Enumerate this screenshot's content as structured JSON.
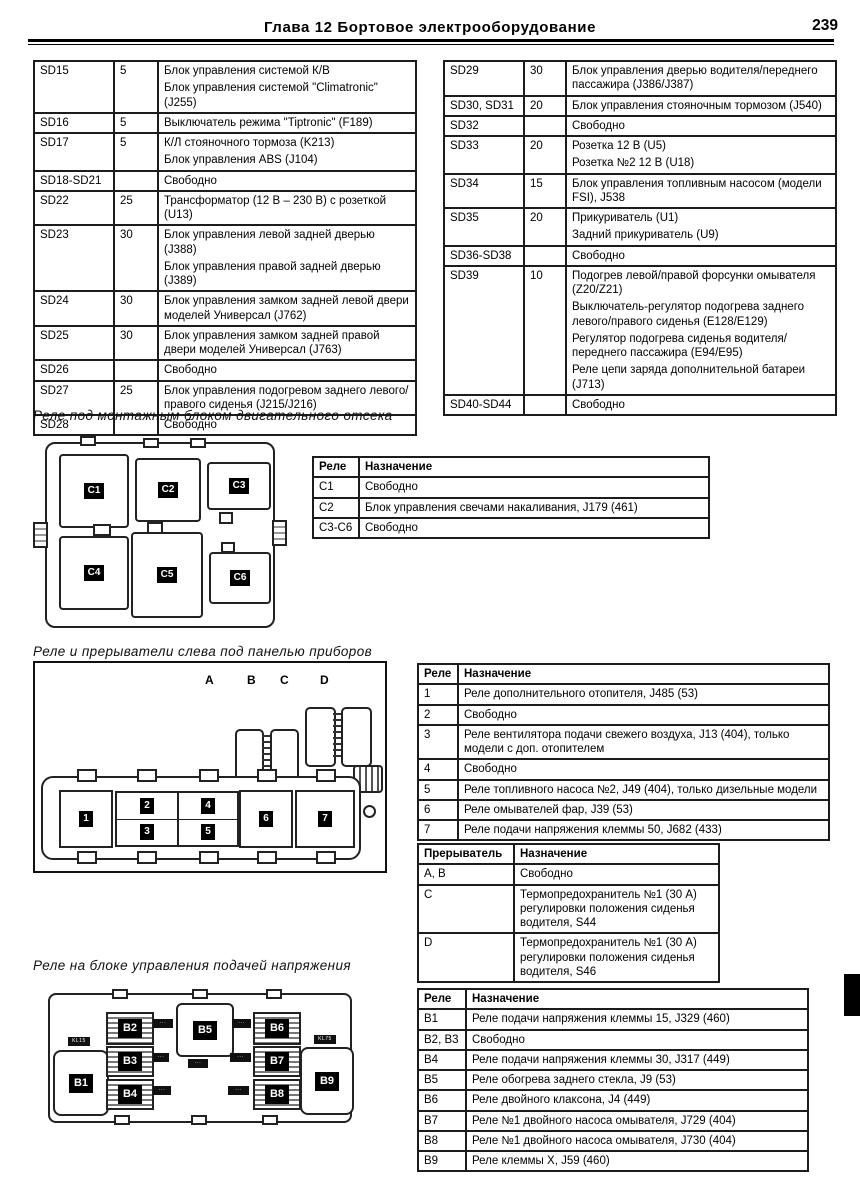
{
  "header": {
    "title": "Глава 12  Бортовое электрооборудование",
    "page_number": "239"
  },
  "fuse_left": {
    "rows": [
      {
        "id": "SD15",
        "amp": "5",
        "desc": [
          "Блок управления системой К/В",
          "Блок управления системой \"Climatronic\" (J255)"
        ]
      },
      {
        "id": "SD16",
        "amp": "5",
        "desc": [
          "Выключатель режима \"Tiptronic\" (F189)"
        ]
      },
      {
        "id": "SD17",
        "amp": "5",
        "desc": [
          "К/Л стояночного тормоза (K213)",
          "Блок управления ABS (J104)"
        ]
      },
      {
        "id": "SD18-SD21",
        "amp": "",
        "desc": [
          "Свободно"
        ]
      },
      {
        "id": "SD22",
        "amp": "25",
        "desc": [
          "Трансформатор (12 В – 230 В) с розеткой (U13)"
        ]
      },
      {
        "id": "SD23",
        "amp": "30",
        "desc": [
          "Блок управления левой задней дверью (J388)",
          "Блок управления правой задней дверью (J389)"
        ]
      },
      {
        "id": "SD24",
        "amp": "30",
        "desc": [
          "Блок управления замком задней левой двери моделей Универсал (J762)"
        ]
      },
      {
        "id": "SD25",
        "amp": "30",
        "desc": [
          "Блок управления замком задней правой двери моделей Универсал (J763)"
        ]
      },
      {
        "id": "SD26",
        "amp": "",
        "desc": [
          "Свободно"
        ]
      },
      {
        "id": "SD27",
        "amp": "25",
        "desc": [
          "Блок управления подогревом заднего левого/правого сиденья (J215/J216)"
        ]
      },
      {
        "id": "SD28",
        "amp": "",
        "desc": [
          "Свободно"
        ]
      }
    ]
  },
  "fuse_right": {
    "rows": [
      {
        "id": "SD29",
        "amp": "30",
        "desc": [
          "Блок управления дверью водителя/переднего пассажира (J386/J387)"
        ]
      },
      {
        "id": "SD30, SD31",
        "amp": "20",
        "desc": [
          "Блок управления стояночным тормозом (J540)"
        ]
      },
      {
        "id": "SD32",
        "amp": "",
        "desc": [
          "Свободно"
        ]
      },
      {
        "id": "SD33",
        "amp": "20",
        "desc": [
          "Розетка 12 В (U5)",
          "Розетка №2 12 В (U18)"
        ]
      },
      {
        "id": "SD34",
        "amp": "15",
        "desc": [
          "Блок управления топливным насосом (модели FSI), J538"
        ]
      },
      {
        "id": "SD35",
        "amp": "20",
        "desc": [
          "Прикуриватель (U1)",
          "Задний прикуриватель (U9)"
        ]
      },
      {
        "id": "SD36-SD38",
        "amp": "",
        "desc": [
          "Свободно"
        ]
      },
      {
        "id": "SD39",
        "amp": "10",
        "desc": [
          "Подогрев левой/правой форсунки омывателя (Z20/Z21)",
          "Выключатель-регулятор подогрева заднего левого/правого сиденья (E128/E129)",
          "Регулятор подогрева сиденья водителя/переднего пассажира (E94/E95)",
          "Реле цепи заряда дополнительной батареи (J713)"
        ]
      },
      {
        "id": "SD40-SD44",
        "amp": "",
        "desc": [
          "Свободно"
        ]
      }
    ]
  },
  "s1": {
    "heading": "Реле под монтажным блоком двигательного отсека",
    "relays": [
      "C1",
      "C2",
      "C3",
      "C4",
      "C5",
      "C6"
    ],
    "table": {
      "h1": "Реле",
      "h2": "Назначение",
      "rows": [
        {
          "id": "C1",
          "desc": "Свободно"
        },
        {
          "id": "C2",
          "desc": "Блок управления свечами накаливания, J179 (461)"
        },
        {
          "id": "C3-C6",
          "desc": "Свободно"
        }
      ]
    }
  },
  "s2": {
    "heading": "Реле и прерыватели слева под панелью приборов",
    "letters": [
      "A",
      "B",
      "C",
      "D"
    ],
    "relays": [
      "1",
      "2",
      "3",
      "4",
      "5",
      "6",
      "7"
    ],
    "relay_table": {
      "h1": "Реле",
      "h2": "Назначение",
      "rows": [
        {
          "id": "1",
          "desc": "Реле дополнительного отопителя, J485 (53)"
        },
        {
          "id": "2",
          "desc": "Свободно"
        },
        {
          "id": "3",
          "desc": "Реле вентилятора подачи свежего воздуха, J13 (404), только модели с доп. отопителем"
        },
        {
          "id": "4",
          "desc": "Свободно"
        },
        {
          "id": "5",
          "desc": "Реле топливного насоса №2, J49 (404), только дизельные модели"
        },
        {
          "id": "6",
          "desc": "Реле омывателей фар, J39 (53)"
        },
        {
          "id": "7",
          "desc": "Реле подачи напряжения клеммы 50, J682 (433)"
        }
      ]
    },
    "breaker_table": {
      "h1": "Прерыватель",
      "h2": "Назначение",
      "rows": [
        {
          "id": "A, B",
          "desc": "Свободно"
        },
        {
          "id": "C",
          "desc": "Термопредохранитель №1 (30 А) регулировки положения сиденья водителя, S44"
        },
        {
          "id": "D",
          "desc": "Термопредохранитель №1 (30 А) регулировки положения сиденья водителя, S46"
        }
      ]
    }
  },
  "s3": {
    "heading": "Реле на блоке управления подачей напряжения",
    "relays": [
      "B1",
      "B2",
      "B3",
      "B4",
      "B5",
      "B6",
      "B7",
      "B8",
      "B9"
    ],
    "badges": {
      "b1": "KL15",
      "b9": "KL75",
      "m1": "···",
      "m2": "···",
      "m3": "···",
      "m4": "···",
      "m5": "···",
      "m6": "···",
      "m7": "···"
    },
    "table": {
      "h1": "Реле",
      "h2": "Назначение",
      "rows": [
        {
          "id": "B1",
          "desc": "Реле подачи напряжения клеммы 15, J329 (460)"
        },
        {
          "id": "B2, B3",
          "desc": "Свободно"
        },
        {
          "id": "B4",
          "desc": "Реле подачи напряжения клеммы 30, J317 (449)"
        },
        {
          "id": "B5",
          "desc": "Реле обогрева заднего стекла, J9 (53)"
        },
        {
          "id": "B6",
          "desc": "Реле двойного клаксона, J4 (449)"
        },
        {
          "id": "B7",
          "desc": "Реле №1 двойного насоса омывателя, J729 (404)"
        },
        {
          "id": "B8",
          "desc": "Реле №1 двойного насоса омывателя, J730 (404)"
        },
        {
          "id": "B9",
          "desc": "Реле клеммы X, J59 (460)"
        }
      ]
    }
  }
}
